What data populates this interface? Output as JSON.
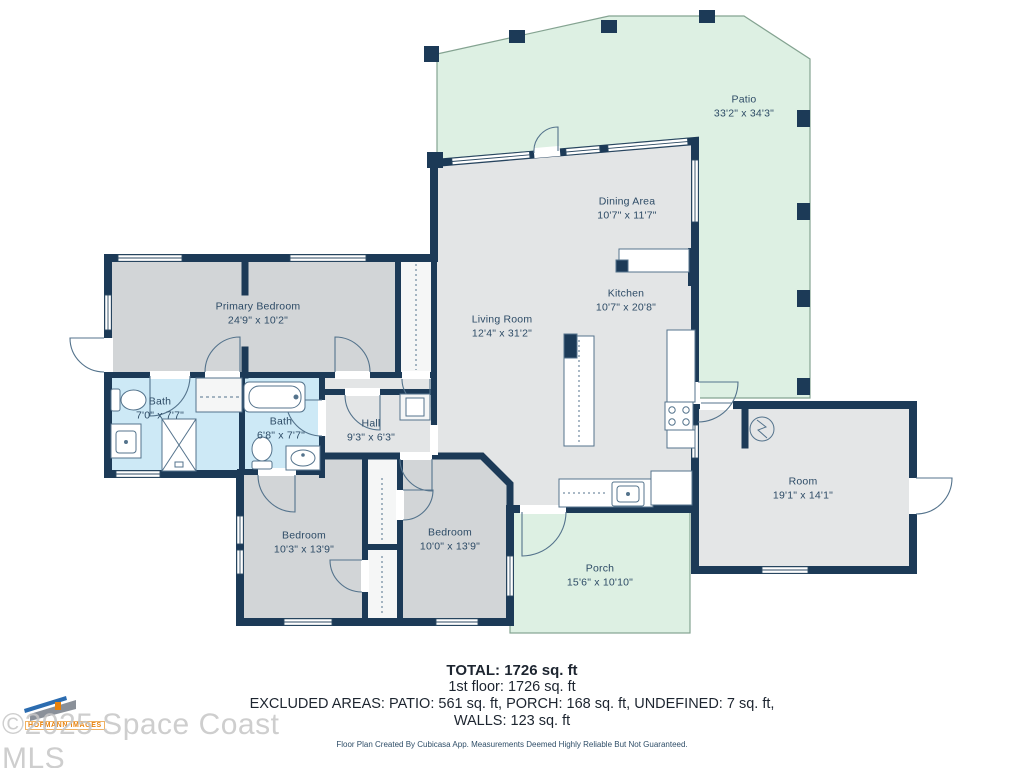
{
  "plan": {
    "rooms": [
      {
        "id": "patio",
        "name": "Patio",
        "dims": "33'2\" x 34'3\""
      },
      {
        "id": "dining",
        "name": "Dining Area",
        "dims": "10'7\" x 11'7\""
      },
      {
        "id": "kitchen",
        "name": "Kitchen",
        "dims": "10'7\" x 20'8\""
      },
      {
        "id": "living",
        "name": "Living Room",
        "dims": "12'4\" x 31'2\""
      },
      {
        "id": "primary-bedroom",
        "name": "Primary Bedroom",
        "dims": "24'9\" x 10'2\""
      },
      {
        "id": "bath-1",
        "name": "Bath",
        "dims": "7'0\" x 7'7\""
      },
      {
        "id": "bath-2",
        "name": "Bath",
        "dims": "6'8\" x 7'7\""
      },
      {
        "id": "hall",
        "name": "Hall",
        "dims": "9'3\" x 6'3\""
      },
      {
        "id": "bedroom-1",
        "name": "Bedroom",
        "dims": "10'3\" x 13'9\""
      },
      {
        "id": "bedroom-2",
        "name": "Bedroom",
        "dims": "10'0\" x 13'9\""
      },
      {
        "id": "porch",
        "name": "Porch",
        "dims": "15'6\" x 10'10\""
      },
      {
        "id": "room",
        "name": "Room",
        "dims": "19'1\" x 14'1\""
      }
    ],
    "colors": {
      "wall": "#1c3a57",
      "floor": "#e3e5e6",
      "bedroom_floor": "#d2d5d7",
      "bath_floor": "#cde9f6",
      "outdoor": "#ddf0e3",
      "label_text": "#2d4b66"
    }
  },
  "summary": {
    "total": "TOTAL: 1726 sq. ft",
    "floor": "1st floor: 1726 sq. ft",
    "excluded": "EXCLUDED AREAS: PATIO: 561 sq. ft, PORCH: 168 sq. ft, UNDEFINED: 7 sq. ft,",
    "walls": "WALLS: 123 sq. ft",
    "disclaimer": "Floor Plan Created By Cubicasa App. Measurements Deemed Highly Reliable But Not Guaranteed."
  },
  "watermark": {
    "logo_text": "HOFMANN IMAGES",
    "copyright": "©2025 Space Coast MLS"
  }
}
